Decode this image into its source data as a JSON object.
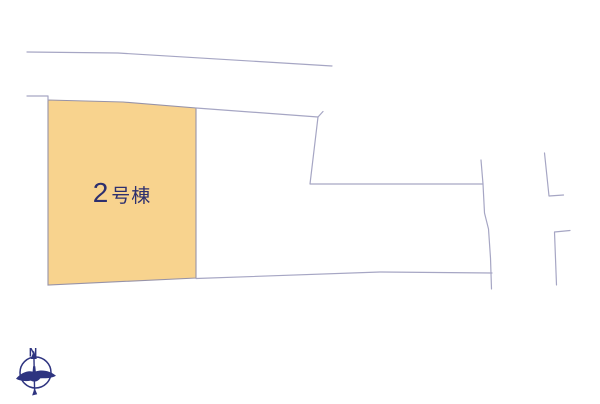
{
  "colors": {
    "background": "#ffffff",
    "boundary_line": "#a6a6c4",
    "parcel_fill": "#f8d38e",
    "parcel_outline": "#9793a8",
    "label_text": "#2d2f6e",
    "compass": "#2e3480"
  },
  "parcel": {
    "label_number": "2",
    "label_suffix": "号棟"
  },
  "compass": {
    "north_label": "N"
  }
}
